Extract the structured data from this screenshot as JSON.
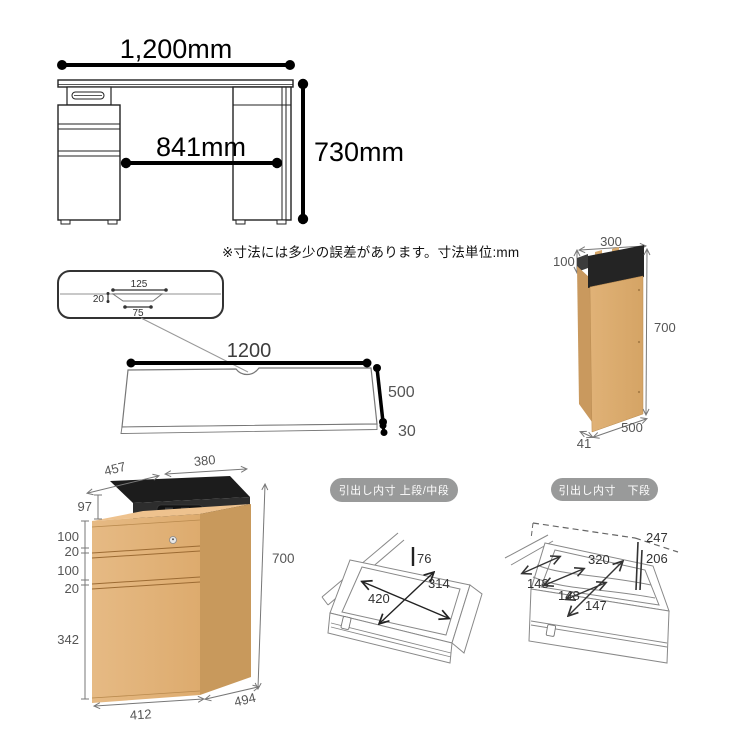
{
  "note": "※寸法には多少の誤差があります。寸法単位:mm",
  "desk_front": {
    "width": "1,200mm",
    "inner_width": "841mm",
    "height": "730mm"
  },
  "side_panel": {
    "top_width": "300",
    "black_box_height": "100",
    "height": "700",
    "depth": "500",
    "thickness": "41"
  },
  "top_view": {
    "notch_top_width": "125",
    "notch_depth": "20",
    "notch_bottom_width": "75",
    "width": "1200",
    "depth": "500",
    "thickness": "30"
  },
  "cabinet": {
    "top_depth": "457",
    "top_width": "380",
    "tray_height": "97",
    "drawer1_height": "100",
    "gap1": "20",
    "drawer2_height": "100",
    "gap2": "20",
    "drawer3_height": "342",
    "height": "700",
    "width": "412",
    "depth": "494"
  },
  "drawer_upper": {
    "label": "引出し内寸 上段/中段",
    "inner_height": "76",
    "inner_depth": "314",
    "inner_width": "420"
  },
  "drawer_lower": {
    "label": "引出し内寸　下段",
    "height_to_top": "247",
    "inner_height": "206",
    "inner_width": "320",
    "section1": "148",
    "section2": "148",
    "section3": "147"
  },
  "colors": {
    "wood_front": "#e2b37b",
    "wood_side": "#c8995c",
    "black_box": "#242424",
    "dimension_line": "#000000",
    "pill_bg": "#999a9a"
  }
}
